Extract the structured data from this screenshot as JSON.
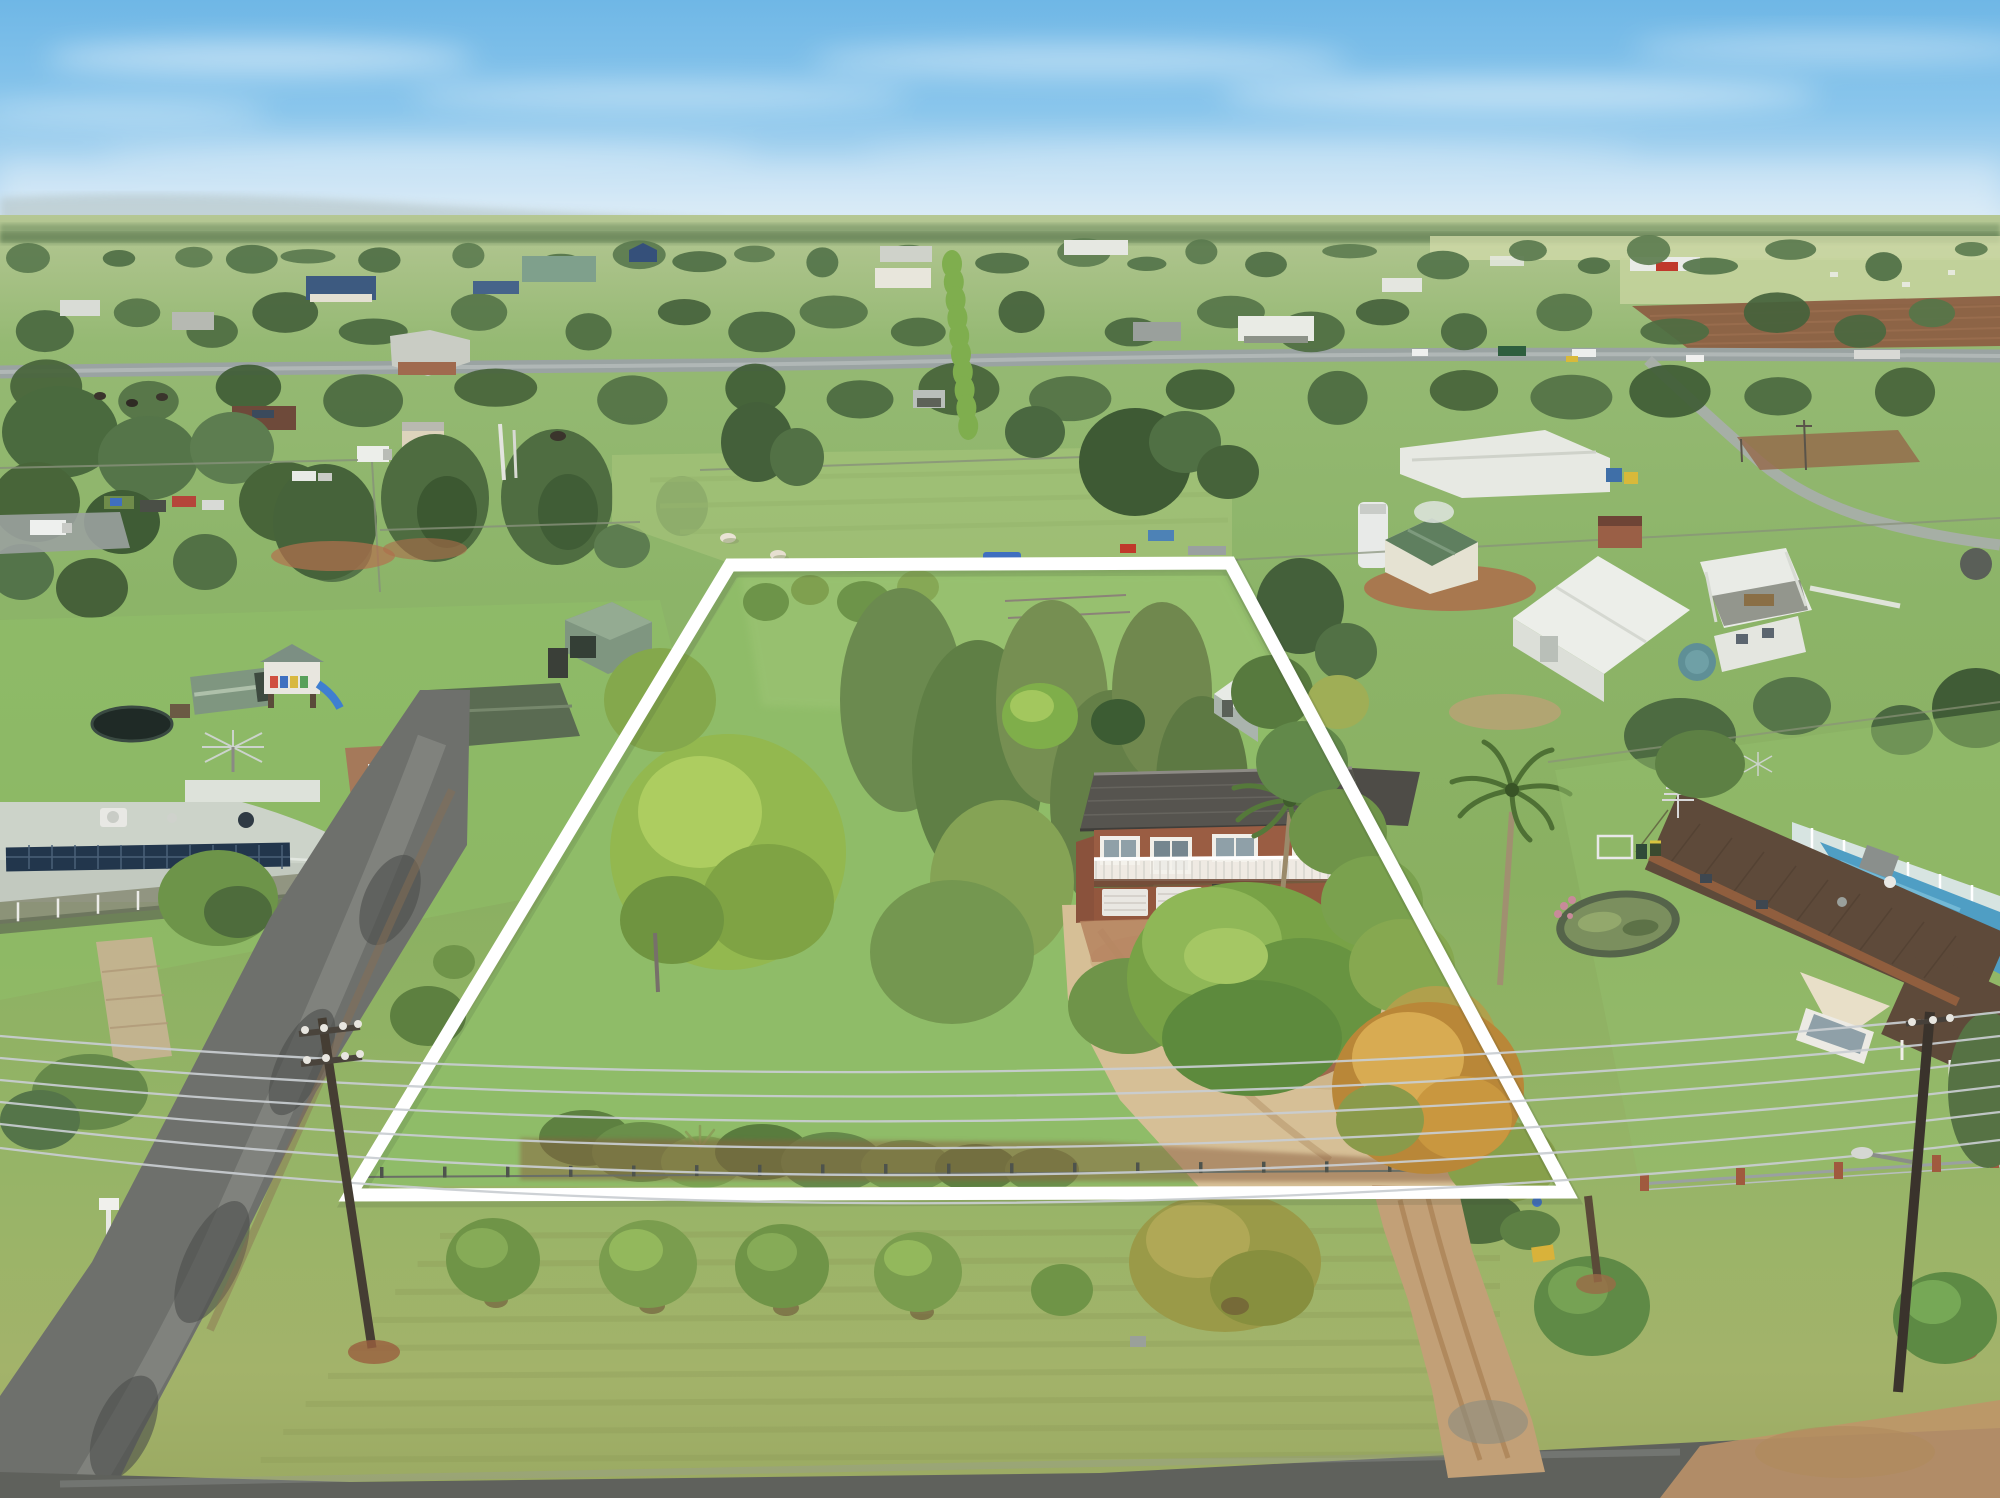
{
  "meta": {
    "description": "Overcast daytime aerial drone photograph of a semi-rural residential property marked with a white boundary outline, surrounded by neighbouring homes, paddocks and distant farmland",
    "canvas": {
      "width": 2000,
      "height": 1498
    }
  },
  "boundary": {
    "color": "#ffffff",
    "stroke_width": 13,
    "corners": {
      "top_left": [
        730,
        565
      ],
      "top_right": [
        1230,
        563
      ],
      "bottom_right": [
        1567,
        1192
      ],
      "bottom_left": [
        350,
        1195
      ]
    }
  },
  "palette": {
    "sky_top": "#6fb7e6",
    "sky_horizon": "#e4f0f6",
    "cloud": "#ffffff",
    "haze": "#edf3f2",
    "field": "#8fb366",
    "lawn": "#8fbc68",
    "foreground_grass": "#a3b36a",
    "tree_dark": "#44603a",
    "tree_mid": "#5d7d4a",
    "tree_bright": "#93b84f",
    "tree_gold": "#b08c45",
    "asphalt_road": "#6e706c",
    "wet_sheen": "#9a9d99",
    "dirt_road": "#c2a077",
    "red_dirt": "#ad6d4b",
    "sand": "#d6bf96",
    "main_house_roof": "#56544f",
    "main_house_brick": "#9a5d43",
    "trim_white": "#f2f0ec",
    "left_house_roof": "#ccd3c9",
    "solar_panel": "#22364c",
    "right_house_roof": "#5e4a3a",
    "pool_water": "#4f9ec4",
    "pool_glass": "#dfe9ee",
    "pond_water": "#7b8f5e",
    "shed_white": "#eceee9",
    "shed_green_roof": "#7f9680",
    "wire": "#c9ced2",
    "pole": "#453d33"
  },
  "scene": {
    "setting": "green paddocks and homes under a pale blue sky with wispy clouds",
    "property": {
      "outlined": true,
      "features": [
        "two-storey brick house with dark tiled gable roof",
        "white balcony railing across the upper floor",
        "two white garage doors below",
        "palm trees beside the house",
        "dense tree-filled garden on the left half",
        "light grey garden shed at rear",
        "sandy front yard with circular brick garden bed",
        "dirt driveway out to the street"
      ]
    },
    "left_neighbour": {
      "features": [
        "long house with pale grey roof and rooftop solar panel array",
        "wrap-around verandah on posts",
        "green garden sheds",
        "children's cubby house with blue slide",
        "dark trampoline",
        "rotary clothesline"
      ]
    },
    "right_neighbour": {
      "features": [
        "brick house with long dark-brown roof",
        "enclosed blue swimming pool",
        "oval garden pond",
        "front fence with brick pillars"
      ]
    },
    "infrastructure": {
      "power_lines": 6,
      "power_poles": 3,
      "roads": [
        "wet asphalt street at lower left",
        "street along the bottom edge",
        "dirt driveway at lower right",
        "distant highway with vehicles"
      ]
    },
    "animals": {
      "sheep_in_paddock": 2
    },
    "distant": [
      "scattered houses among trees",
      "fenced green paddocks",
      "brown ploughed field",
      "pale airfield with white hangar and red door",
      "tree-lined hazy horizon"
    ]
  }
}
